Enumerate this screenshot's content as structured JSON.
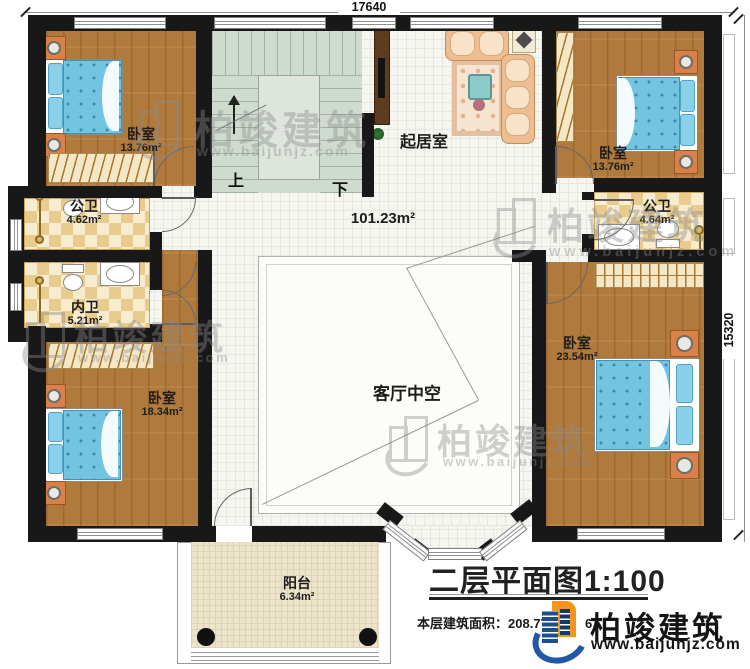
{
  "dimensions": {
    "top": "17640",
    "right": "15320"
  },
  "stairs": {
    "up": "上",
    "down": "下"
  },
  "rooms": {
    "bedroom_tl": {
      "name": "卧室",
      "area": "13.76m²"
    },
    "bedroom_tr": {
      "name": "卧室",
      "area": "13.76m²"
    },
    "living": {
      "name": "起居室"
    },
    "hall": {
      "area": "101.23m²"
    },
    "bath_public_left": {
      "name": "公卫",
      "area": "4.62m²"
    },
    "bath_inner": {
      "name": "内卫",
      "area": "5.21m²"
    },
    "bath_public_right": {
      "name": "公卫",
      "area": "4.64m²"
    },
    "bedroom_bl": {
      "name": "卧室",
      "area": "18.34m²"
    },
    "bedroom_br": {
      "name": "卧室",
      "area": "23.54m²"
    },
    "void": {
      "name": "客厅中空"
    },
    "balcony": {
      "name": "阳台",
      "area": "6.34m²"
    }
  },
  "titleblock": {
    "title": "二层平面图1:100",
    "area_label": "本层建筑面积：",
    "area_value": "208.77m²",
    "note_fragment": "6"
  },
  "brand": {
    "name": "柏竣建筑",
    "url": "www.baijunjz.com"
  },
  "watermark": {
    "name": "柏竣建筑",
    "url": "www.baijunjz.com"
  },
  "colors": {
    "accent_orange": "#f7941d",
    "accent_blue": "#2157a5",
    "wall": "#181818",
    "wood": "#b07a3c"
  }
}
